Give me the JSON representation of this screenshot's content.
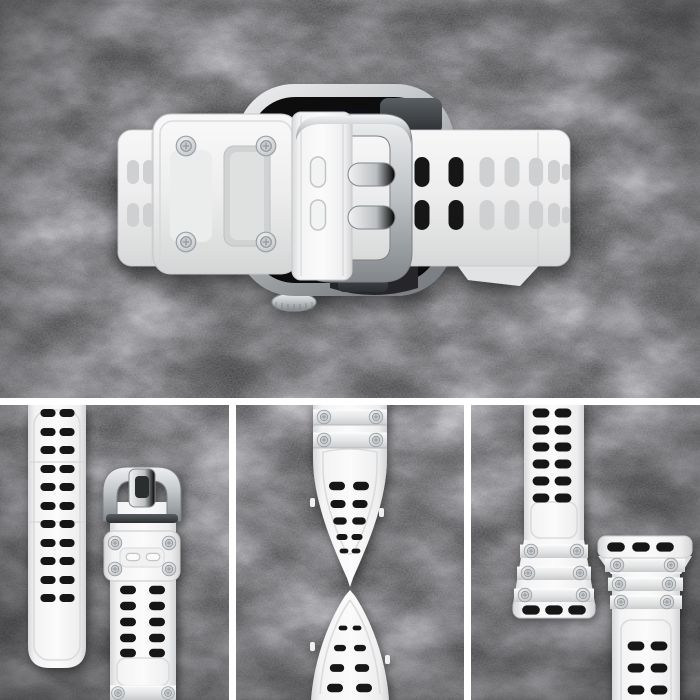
{
  "scene": {
    "type": "product-photo",
    "subject": "White rugged smartwatch strap with steel buckle mounted on a silver smartwatch, flat-lay on black slate stone",
    "regions": {
      "hero": "Top-down view of the watch with the white perforated strap and steel buckle fastened across the case",
      "panel_left": "Perforated strap tail beside the buckle strap with screwed keeper",
      "panel_middle": "Strap twisted into a spiral to show flexibility",
      "panel_right": "Two strap halves showing the watch-lug connector ends with screws and slots"
    }
  },
  "colors": {
    "background": "#151517",
    "strap-white": "#f7f7f8",
    "strap-shadow": "#d5d6d7",
    "steel-light": "#f1f2f3",
    "steel-mid": "#bcbfc2",
    "steel-dark": "#85898d",
    "hole-dark": "#161617",
    "hole-translucent": "#cfd0d1",
    "watch-screen": "#0a0a0b",
    "divider-white": "#ffffff"
  },
  "details": {
    "hero_hole_rows": 2,
    "left_strip_hole_rows": 11,
    "left_strap_hole_rows": 5,
    "keeper_screws": 4,
    "connector_slots": 3,
    "adapter_screw_rows": 3,
    "twist_screw_rows": 2
  }
}
